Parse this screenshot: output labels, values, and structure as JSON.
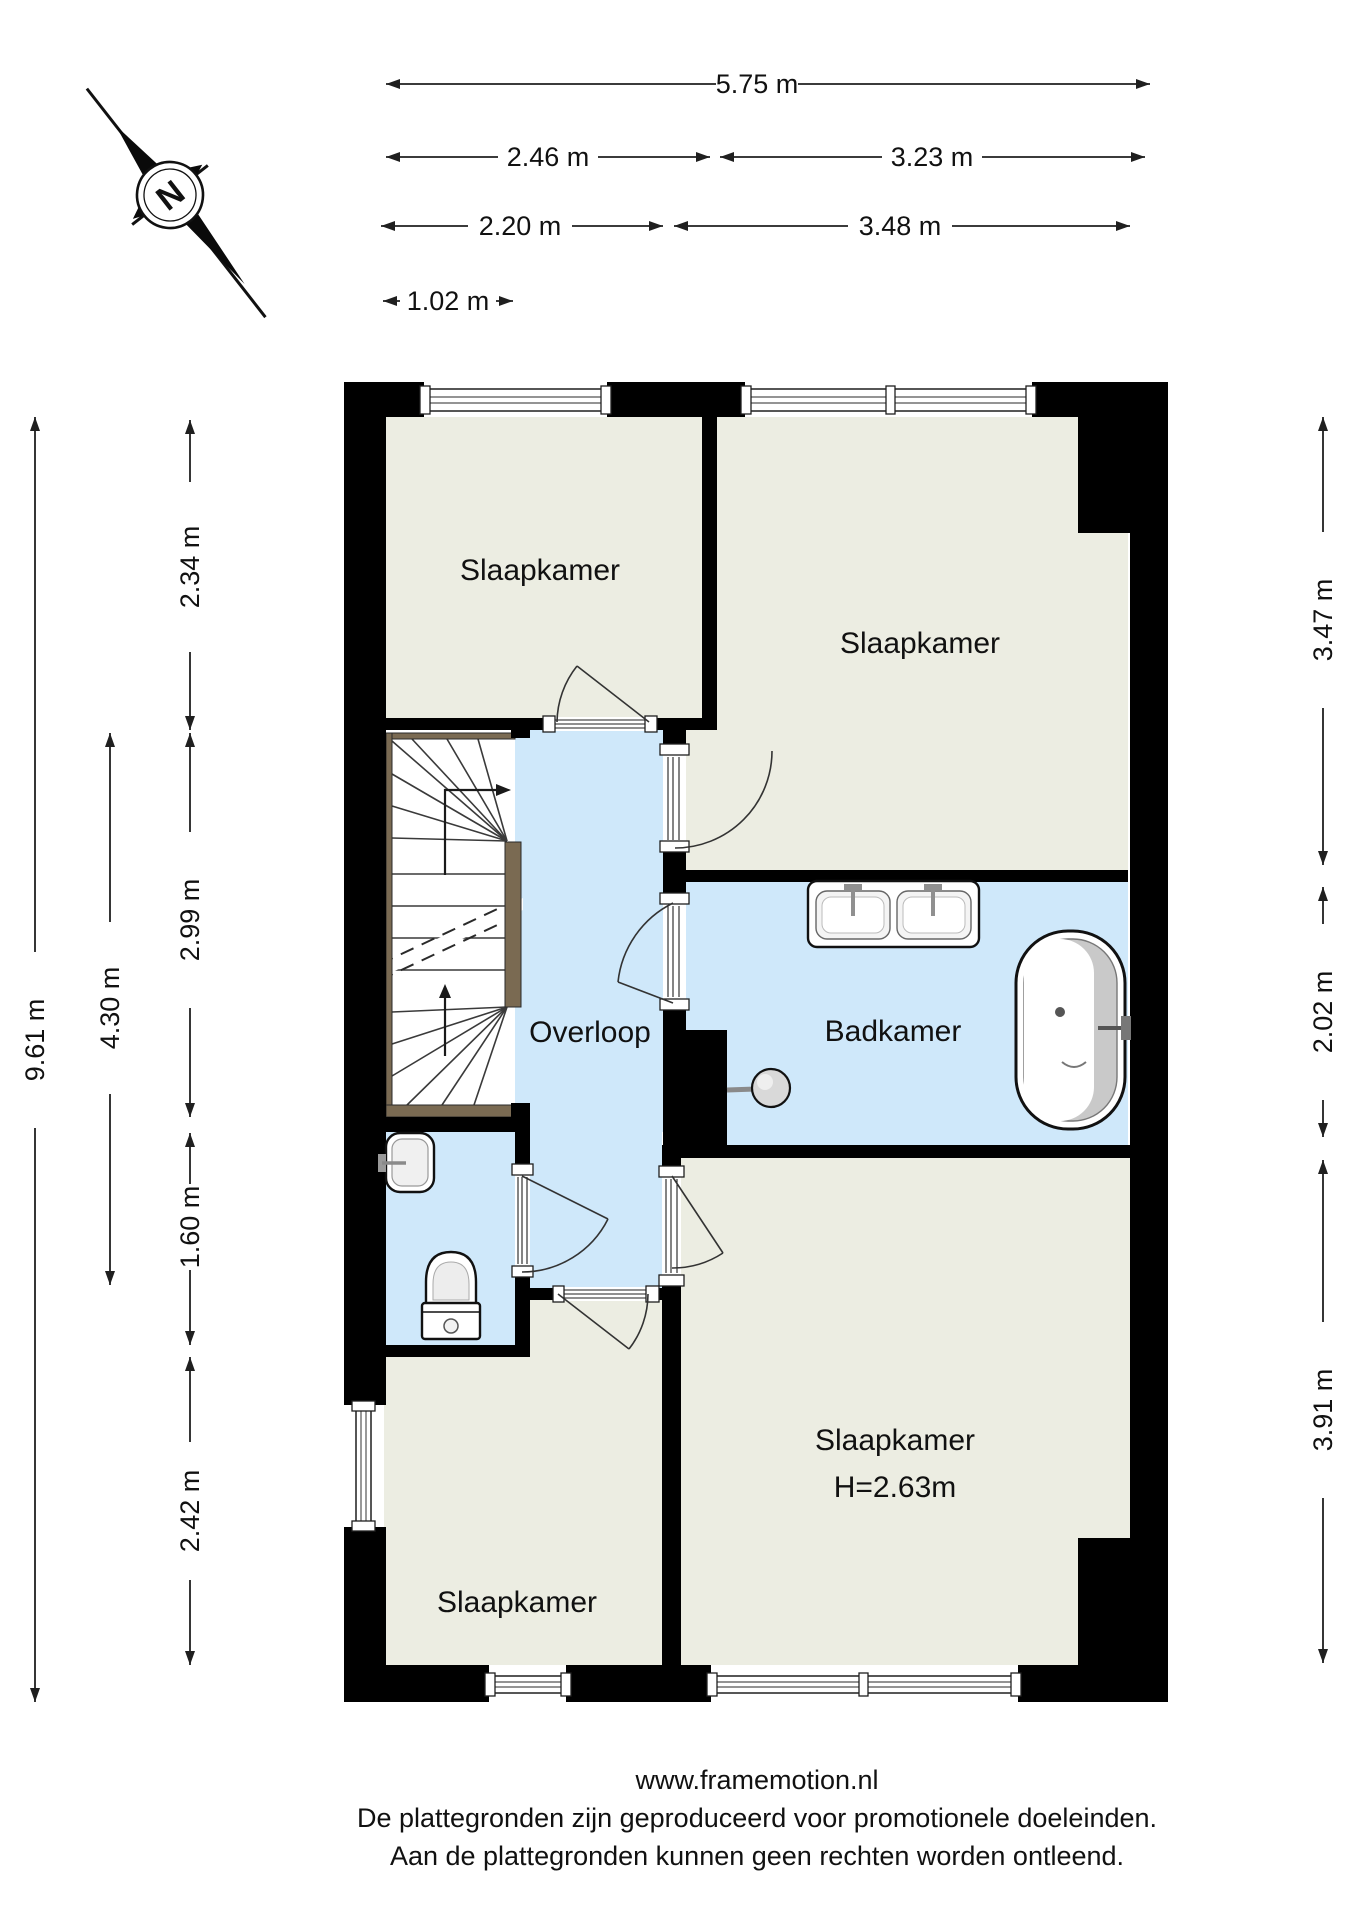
{
  "compass": {
    "north_label": "N"
  },
  "dimensions": {
    "top_total": "5.75 m",
    "top_left_a": "2.46 m",
    "top_right_a": "3.23 m",
    "top_left_b": "2.20 m",
    "top_right_b": "3.48 m",
    "stair_width": "1.02 m",
    "left_total": "9.61 m",
    "left_landing": "4.30 m",
    "left_a": "2.34 m",
    "left_b": "2.99 m",
    "left_c": "1.60 m",
    "left_d": "2.42 m",
    "right_a": "3.47 m",
    "right_b": "2.02 m",
    "right_c": "3.91 m"
  },
  "rooms": {
    "bedroom_top_left": "Slaapkamer",
    "bedroom_top_right": "Slaapkamer",
    "landing": "Overloop",
    "bathroom": "Badkamer",
    "bedroom_bottom_right_line1": "Slaapkamer",
    "bedroom_bottom_right_line2": "H=2.63m",
    "bedroom_bottom_left": "Slaapkamer"
  },
  "footer": {
    "line1": "www.framemotion.nl",
    "line2": "De plattegronden zijn geproduceerd voor promotionele doeleinden.",
    "line3": "Aan de plattegronden kunnen geen rechten worden ontleend."
  },
  "colors": {
    "wall": "#000000",
    "room_fill": "#ECEDE2",
    "wet_room_fill": "#CFE8FA",
    "stair_wood": "#7A6A52"
  }
}
